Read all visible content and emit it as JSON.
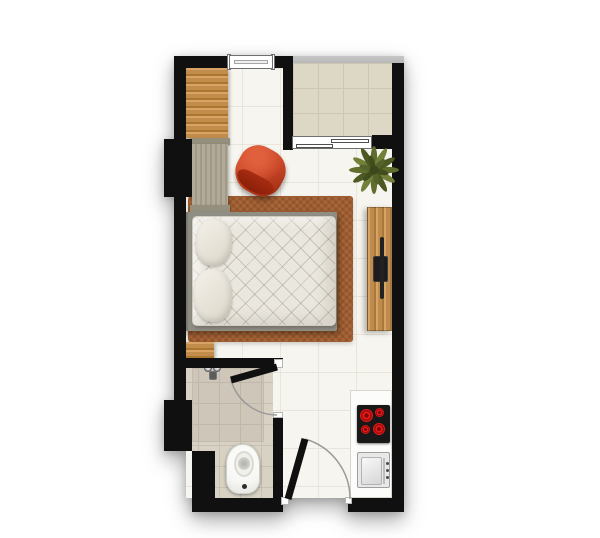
{
  "scene": {
    "description": "studio apartment floor plan, top-down view",
    "background": "#ffffff"
  },
  "rooms": [
    "main-room",
    "balcony",
    "bathroom",
    "kitchenette-entry"
  ],
  "furniture": [
    "double-bed-with-pillows",
    "area-rug",
    "wardrobe",
    "wood-closet",
    "red-lounge-chair",
    "tv-console",
    "flat-screen-tv",
    "potted-plant",
    "kitchen-counter",
    "four-burner-cooktop",
    "kitchen-sink",
    "toilet",
    "shower-mixer",
    "bathroom-door",
    "entrance-door",
    "window",
    "balcony-sliding-door",
    "balcony-railing"
  ],
  "colors": {
    "wall": "#101010",
    "floor-main": "#f7f5ef",
    "tile-line-main": "#e9e5da",
    "floor-balcony": "#ddd7c5",
    "tile-line-balcony": "#cdc6b2",
    "floor-bath": "#d8d2c4",
    "tile-line-bath": "#c8c1b1",
    "shower-tint": "rgba(120,110,90,0.10)",
    "rail": "#b8b8b8",
    "wood": "#c18c4c",
    "wood-grain": "#a9762f",
    "wood-light": "#d7a466",
    "wardrobe": "#b2aa99",
    "wardrobe-stripe": "#a29a89",
    "wardrobe-cap": "#95907e",
    "rug": "#a05c2e",
    "bed-frame": "#8f8e84",
    "mattress": "#eae7df",
    "quilt-line": "rgba(125,115,95,0.30)",
    "pillow": "#f4f1ea",
    "pillow-shade": "#dcd6c8",
    "chair": "#c84526",
    "chair-dark": "#8a1f09",
    "plant-dark": "#4c5922",
    "plant-mid": "#5f6e2c",
    "plant-light": "#72813a",
    "counter": "#fcfcfa",
    "counter-edge": "#d9d6cd",
    "stove": "#181818",
    "burner": "#e81a1a",
    "burner-dark": "#7e0606",
    "sink": "#e8e8e8",
    "sink-edge": "#9f9f9f",
    "tv-wood": "#bd8c4e",
    "tv": "#1c1c1c",
    "toilet": "#f6f6f3",
    "door": "#101010",
    "door-arc": "#9a9a9a",
    "frame-white": "#ffffff",
    "frame-edge": "#6f6f6f"
  }
}
